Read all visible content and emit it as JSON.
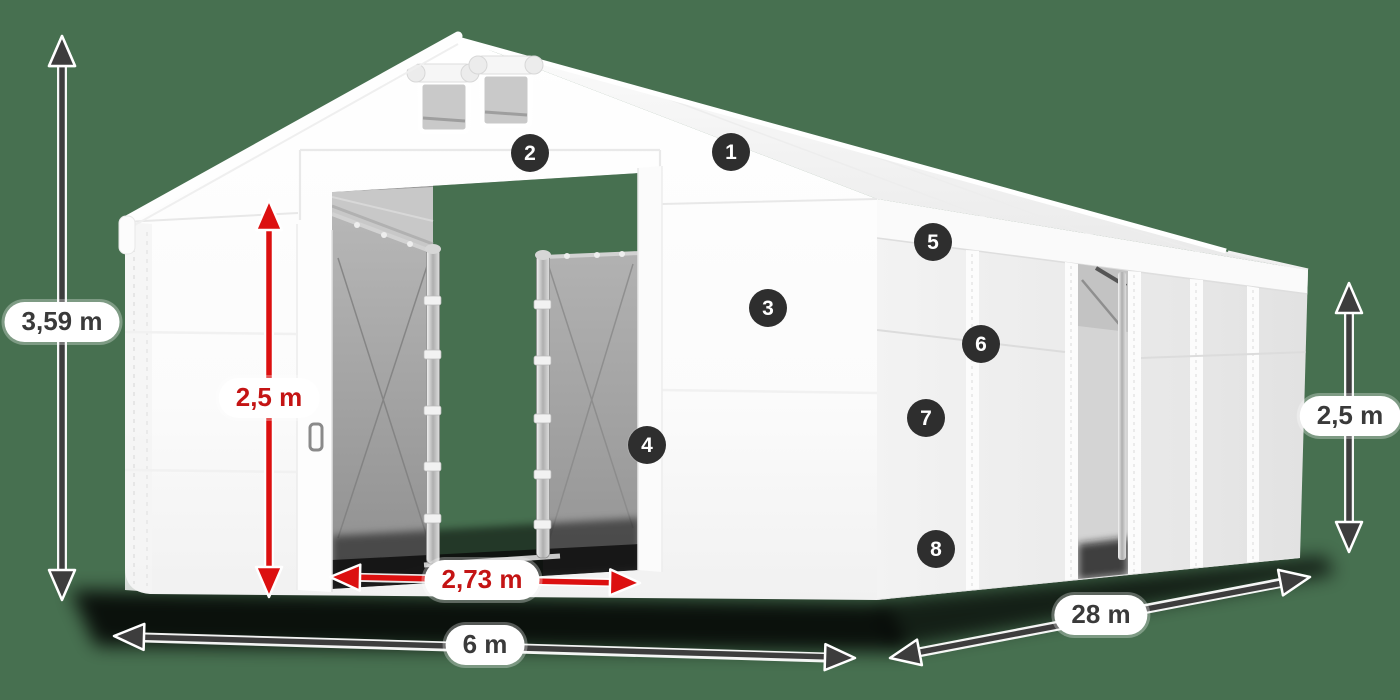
{
  "scene": {
    "type": "product-dimension-diagram",
    "subject": "White storage tent / marquee 6 x 28 m, front-left 3D view with open front doors and open side sliding door",
    "background_color": "#477050",
    "tent_color": "#ffffff",
    "shadow_color": "#000000"
  },
  "badges": [
    "1",
    "2",
    "3",
    "4",
    "5",
    "6",
    "7",
    "8"
  ],
  "badge_style": {
    "bg": "#2e2e2e",
    "fg": "#ffffff"
  },
  "dimensions": {
    "total_height": {
      "label": "3,59 m",
      "style": "dark",
      "orientation": "vertical",
      "position": "far-left"
    },
    "door_height": {
      "label": "2,5 m",
      "style": "red",
      "orientation": "vertical",
      "position": "front-door"
    },
    "door_width": {
      "label": "2,73 m",
      "style": "red",
      "orientation": "horizontal",
      "position": "front-door-base"
    },
    "width": {
      "label": "6 m",
      "style": "dark",
      "orientation": "horizontal",
      "position": "front-bottom"
    },
    "length": {
      "label": "28 m",
      "style": "dark",
      "orientation": "diagonal",
      "position": "side-bottom"
    },
    "side_height": {
      "label": "2,5 m",
      "style": "dark",
      "orientation": "vertical",
      "position": "far-right"
    }
  },
  "colors": {
    "arrow_dark": "#3d3d3d",
    "arrow_red": "#dc1010",
    "pill_bg": "#ffffff",
    "pill_text_dark": "#3a3a3a",
    "pill_text_red": "#c41414",
    "doorway_backdrop": "#477050"
  }
}
